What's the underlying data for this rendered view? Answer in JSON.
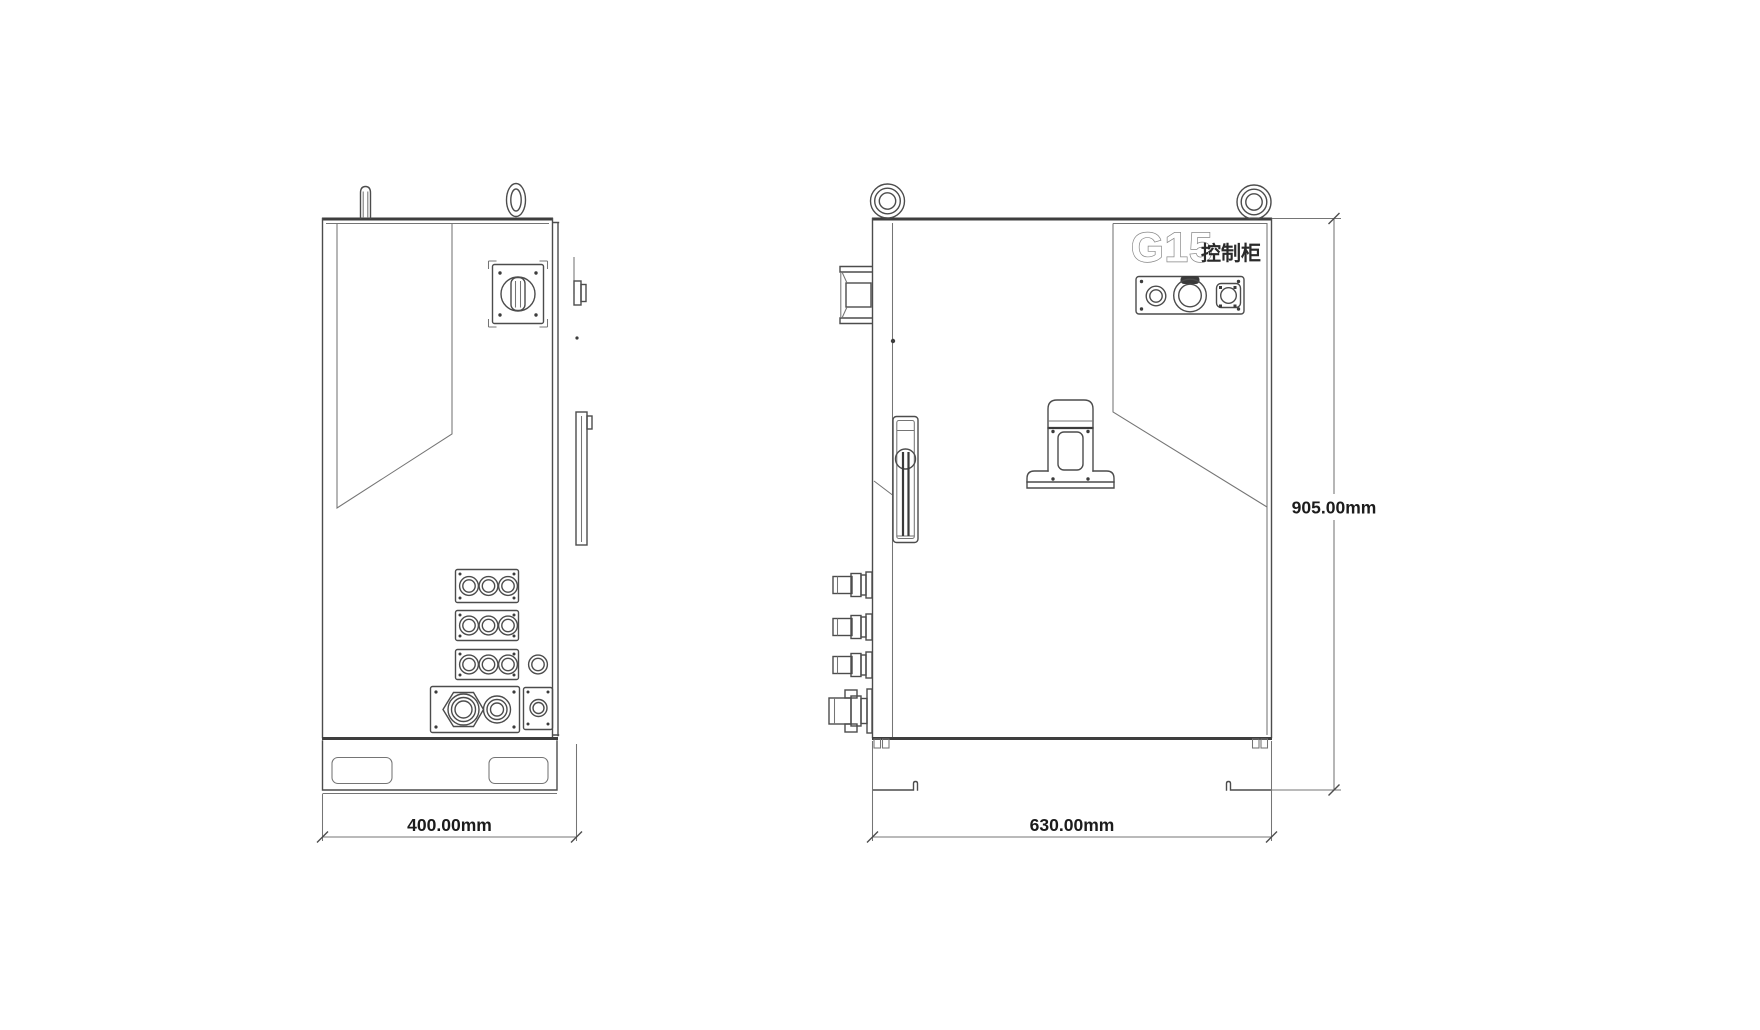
{
  "drawing": {
    "labels": {
      "model": "G15",
      "cabinet_type": "控制柜",
      "side_view_width": "400.00mm",
      "front_view_width": "630.00mm",
      "front_view_height": "905.00mm"
    },
    "colors": {
      "background": "#ffffff",
      "line": "#4c4c4c",
      "heavy_line": "#3e3e3e",
      "dimension_text": "#1c1c1c",
      "model_outline": "#858585"
    }
  }
}
